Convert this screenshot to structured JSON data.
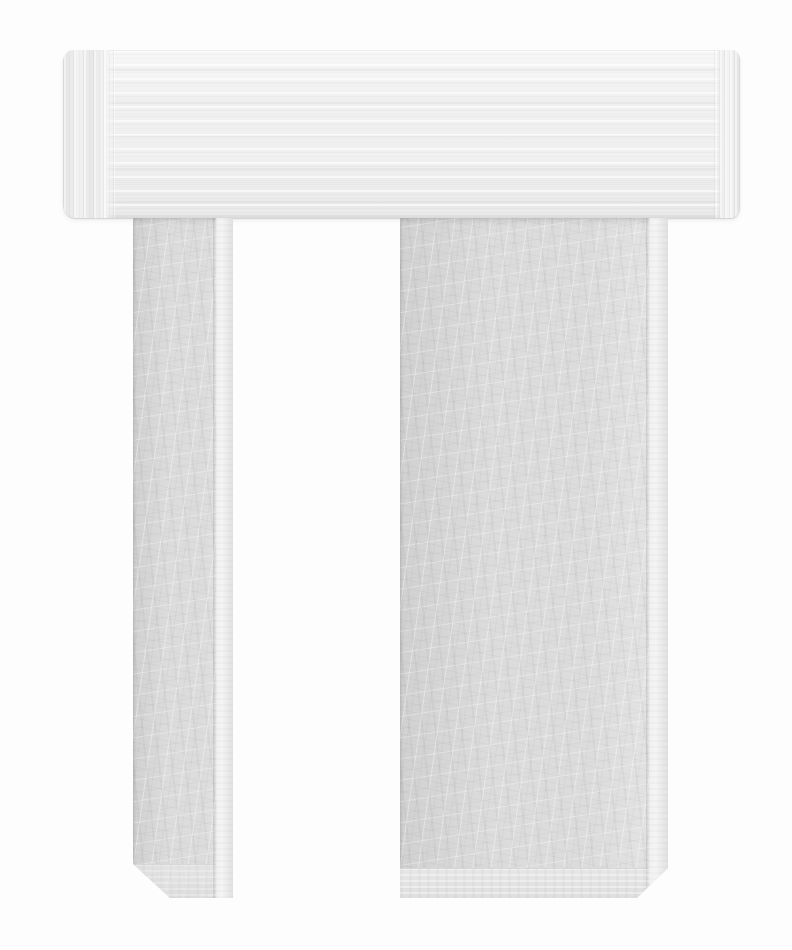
{
  "scene": {
    "description": "Product photograph of a galvanized steel U-shaped end cap: a horizontal top crossbar with rolled edges and brushed texture, and two downward legs (narrow left, wide right) with chamfered bottom corners, on a plain white background",
    "text_content": "none"
  },
  "palette": {
    "background": "#fdfdfd",
    "cap_base": "#f0f0f0",
    "cap_light": "#f7f7f7",
    "cap_dark": "#e9e9e9",
    "cap_edge": "#e2e2e2",
    "leg_base": "#dcdcdc",
    "leg_light": "#e5e5e5",
    "leg_dark": "#d1d1d1",
    "strip_light": "#f1f1f1",
    "strip_dark": "#e0e0e0",
    "band_light": "#e7e7e7"
  }
}
